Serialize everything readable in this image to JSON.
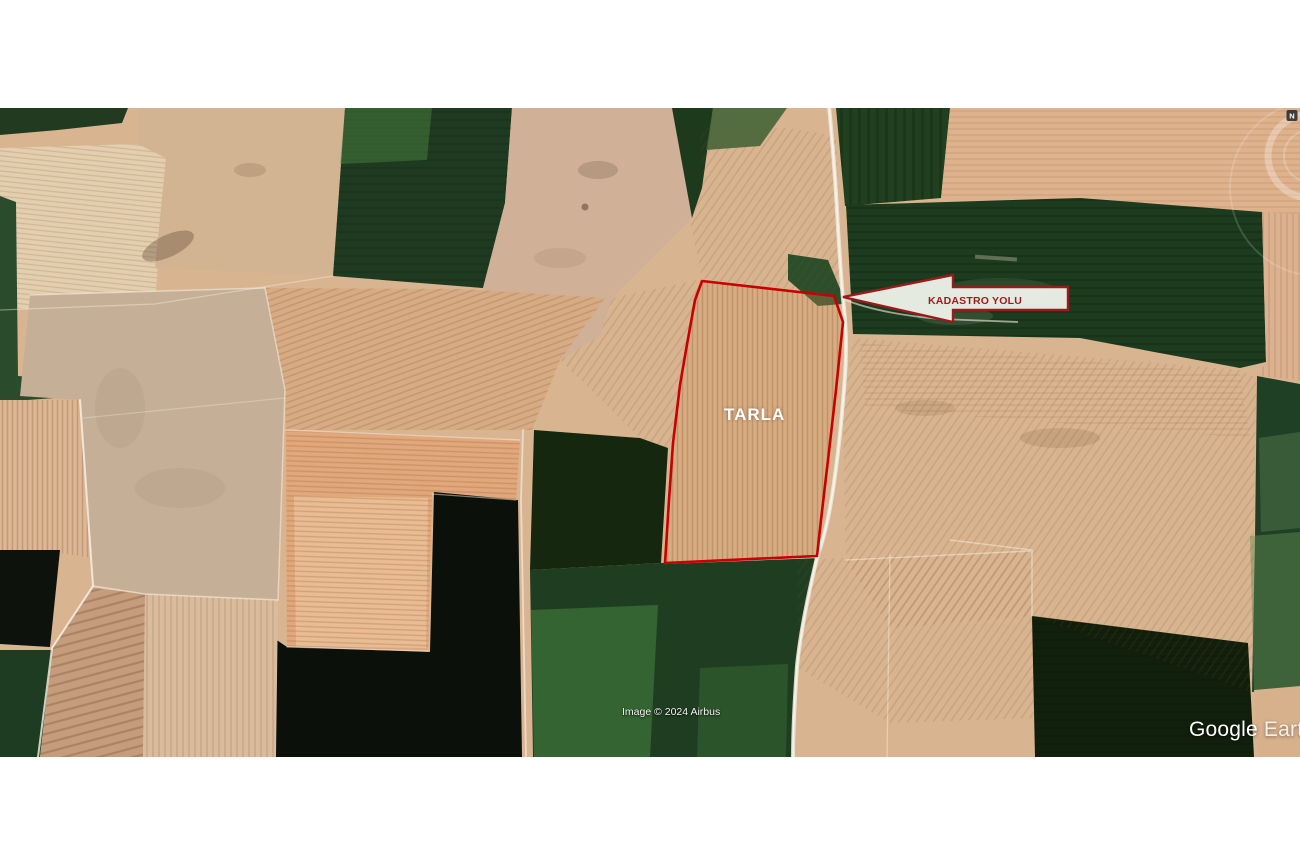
{
  "map": {
    "attribution": "Image © 2024 Airbus",
    "watermark": {
      "brand": "Google",
      "product": "Earth"
    },
    "compass": {
      "north_label": "N"
    },
    "parcel": {
      "label": "TARLA",
      "outline_color": "#c80000",
      "label_color": "#ffffff"
    },
    "annotation_arrow": {
      "label": "KADASTRO YOLU",
      "fill_color": "#edf1e9",
      "border_color": "#9b1b1b",
      "text_color": "#9b1b1b"
    }
  }
}
